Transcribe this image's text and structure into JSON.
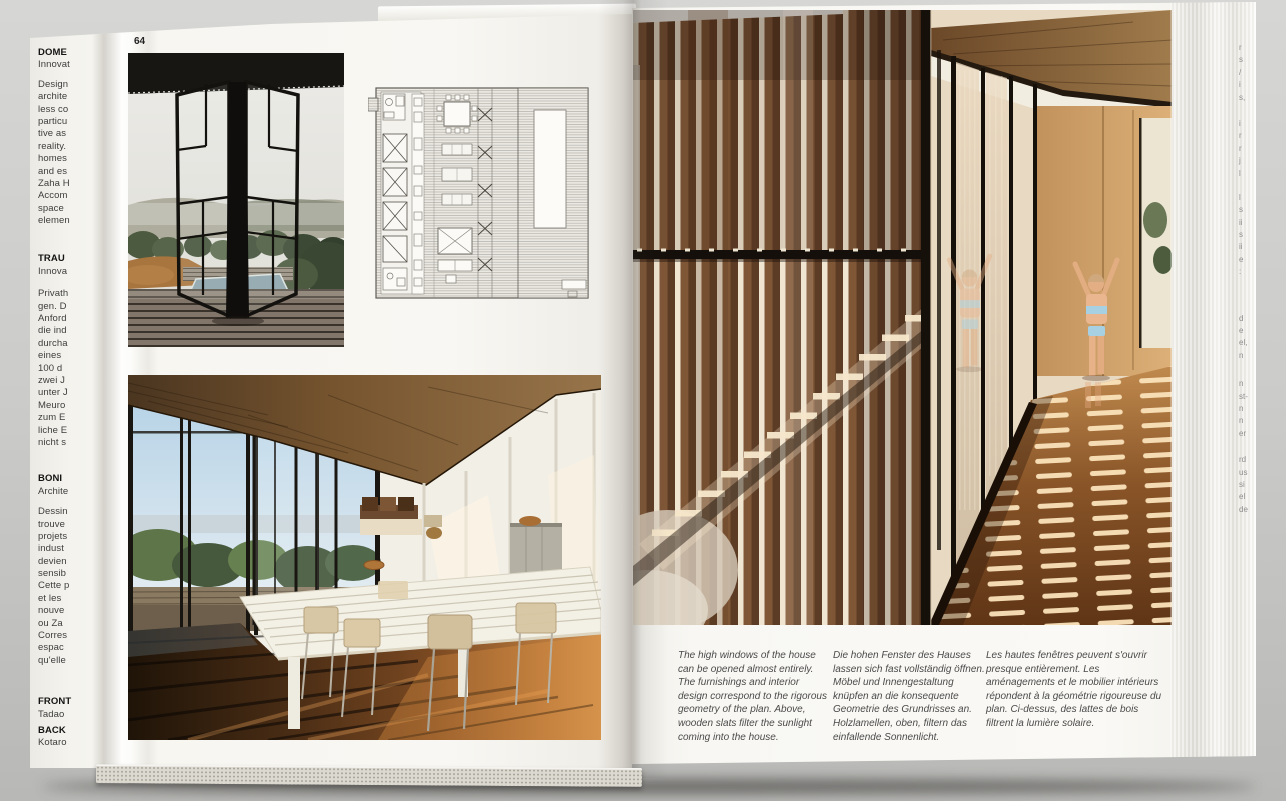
{
  "left_page": {
    "page_number": "64"
  },
  "captions": {
    "en": "The high windows of the house can be opened almost entirely. The furnishings and interior design correspond to the rigorous geometry of the plan. Above, wooden slats filter the sunlight coming into the house.",
    "de": "Die hohen Fenster des Hauses lassen sich fast vollständig öffnen. Möbel und Innengestaltung knüpfen an die konsequente Geometrie des Grundrisses an. Holzlamellen, oben, filtern das einfallende Sonnenlicht.",
    "fr": "Les hautes fenêtres peuvent s'ouvrir presque entièrement. Les aménagements et le mobilier intérieurs répondent à la géométrie rigoureuse du plan. Ci-dessus, des lattes de bois filtrent la lumière solaire."
  },
  "left_margin_lines": [
    {
      "t": "DOME",
      "b": true
    },
    {
      "t": "Innovat"
    },
    {
      "t": "Design",
      "g": 7
    },
    {
      "t": "archite"
    },
    {
      "t": "less co"
    },
    {
      "t": "particu"
    },
    {
      "t": "tive as"
    },
    {
      "t": "reality."
    },
    {
      "t": "homes"
    },
    {
      "t": "and es"
    },
    {
      "t": "Zaha H"
    },
    {
      "t": "Accom"
    },
    {
      "t": "space"
    },
    {
      "t": "elemen"
    },
    {
      "t": "TRAU",
      "b": true,
      "g": 26
    },
    {
      "t": "Innova"
    },
    {
      "t": "Privath",
      "g": 10
    },
    {
      "t": "gen. D"
    },
    {
      "t": "Anford"
    },
    {
      "t": "die ind"
    },
    {
      "t": "durcha"
    },
    {
      "t": "eines"
    },
    {
      "t": "100 d"
    },
    {
      "t": "zwei J"
    },
    {
      "t": "unter J"
    },
    {
      "t": "Meuro"
    },
    {
      "t": "zum E"
    },
    {
      "t": "liche E"
    },
    {
      "t": "nicht s"
    },
    {
      "t": "BONI",
      "b": true,
      "g": 24
    },
    {
      "t": "Archite"
    },
    {
      "t": "Dessin",
      "g": 8
    },
    {
      "t": "trouve"
    },
    {
      "t": "projets"
    },
    {
      "t": "indust"
    },
    {
      "t": "devien"
    },
    {
      "t": "sensib"
    },
    {
      "t": "Cette p"
    },
    {
      "t": "et les"
    },
    {
      "t": "nouve"
    },
    {
      "t": "ou Za"
    },
    {
      "t": "Corres"
    },
    {
      "t": "espac"
    },
    {
      "t": "qu'elle"
    },
    {
      "t": "FRONT",
      "b": true,
      "g": 29
    },
    {
      "t": "Tadao"
    },
    {
      "t": "BACK",
      "b": true,
      "g": 4
    },
    {
      "t": "Kotaro"
    }
  ],
  "edge_fragments": [
    {
      "t": "r"
    },
    {
      "t": "s"
    },
    {
      "t": "/"
    },
    {
      "t": "i"
    },
    {
      "t": "s,"
    },
    {
      "t": "i",
      "g": 14
    },
    {
      "t": "r"
    },
    {
      "t": "r"
    },
    {
      "t": "j"
    },
    {
      "t": "l"
    },
    {
      "t": "l",
      "g": 12
    },
    {
      "t": "s"
    },
    {
      "t": "ii"
    },
    {
      "t": "s"
    },
    {
      "t": "ii"
    },
    {
      "t": "e"
    },
    {
      "t": ":"
    },
    {
      "t": "d",
      "g": 34
    },
    {
      "t": "e"
    },
    {
      "t": "el,"
    },
    {
      "t": "n"
    },
    {
      "t": "n",
      "g": 16
    },
    {
      "t": "st-"
    },
    {
      "t": "n"
    },
    {
      "t": "n"
    },
    {
      "t": "er"
    },
    {
      "t": "rd",
      "g": 14
    },
    {
      "t": "us"
    },
    {
      "t": "si"
    },
    {
      "t": "el"
    },
    {
      "t": "de"
    }
  ],
  "colors": {
    "page_white": "#f8f7f3",
    "surround_grey": "#c9c9c7",
    "caption_text": "#4a4a4a",
    "slat_brown": "#7f5737",
    "slat_gap_cream": "#efe5d1",
    "floor_brown": "#6a3c1a",
    "frame_black": "#16100a"
  }
}
